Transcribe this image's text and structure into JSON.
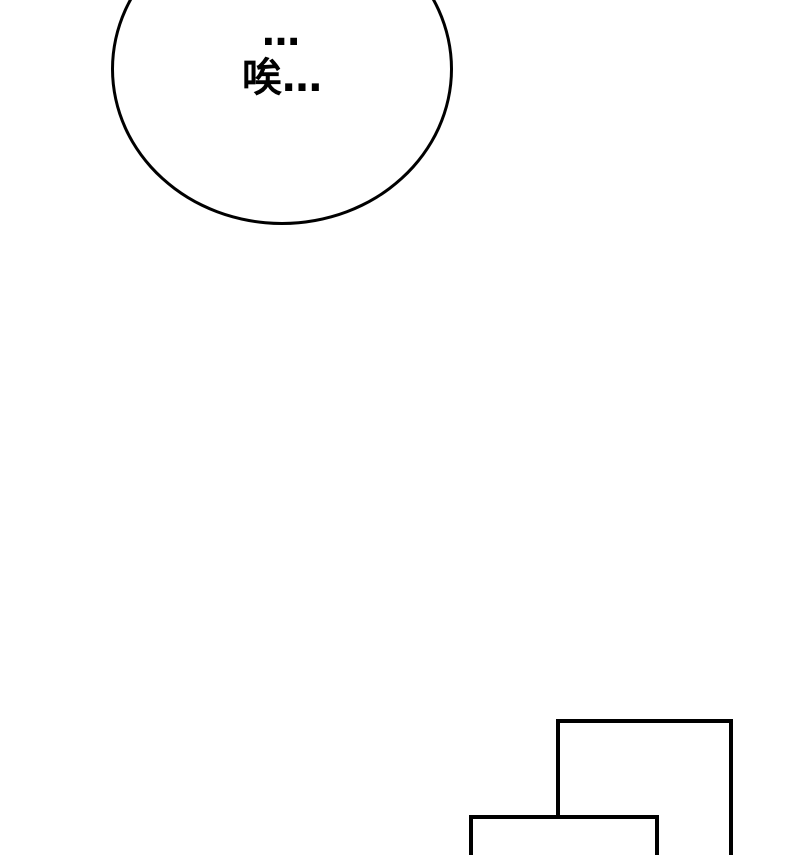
{
  "page": {
    "background_color": "#ffffff",
    "line_color": "#000000"
  },
  "speech_bubble": {
    "line1": "…",
    "line2": "唉…"
  },
  "panels": {
    "count": 2,
    "description": "empty-panel-frames"
  }
}
